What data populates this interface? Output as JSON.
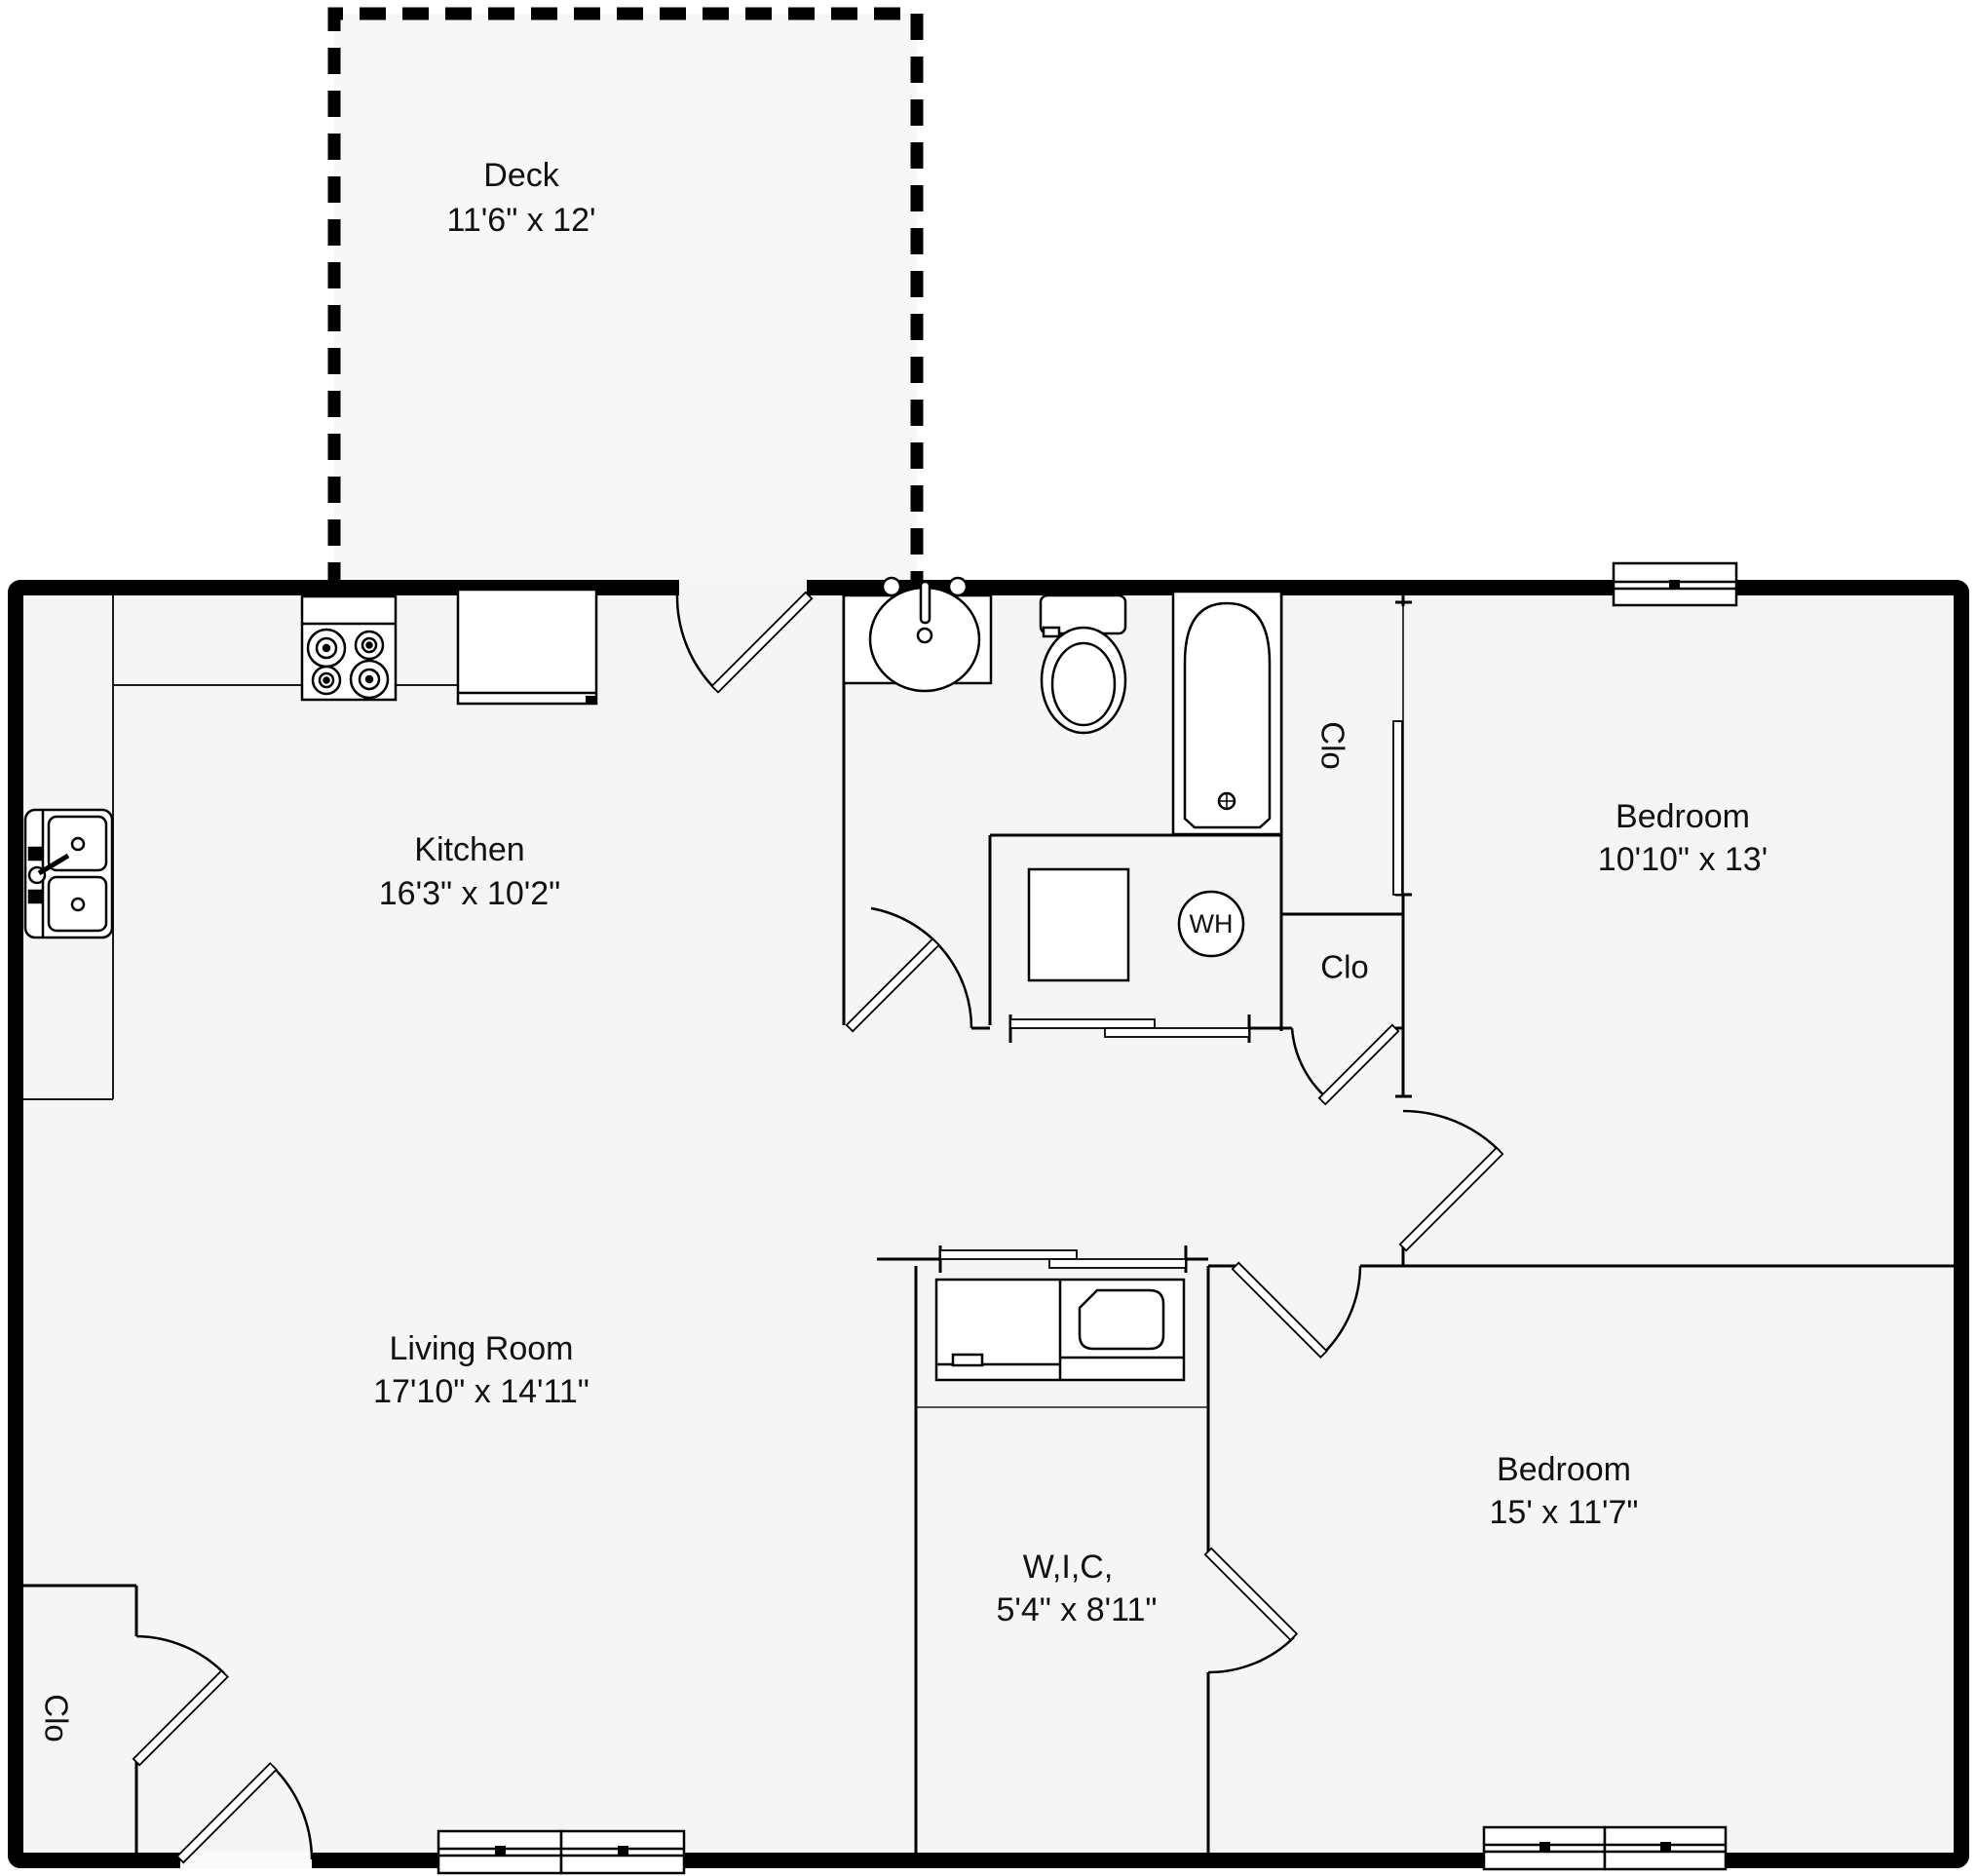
{
  "plan_title": "Apartment floor plan",
  "colors": {
    "wall": "#000000",
    "interior_line": "#1a1a1a",
    "floor_fill": "#f5f5f5",
    "deck_fill": "#f7f7f7",
    "background": "#ffffff",
    "fixture_fill": "#ffffff"
  },
  "rooms": {
    "deck": {
      "name": "Deck",
      "dims": "11'6\" x 12'"
    },
    "kitchen": {
      "name": "Kitchen",
      "dims": "16'3\" x 10'2\""
    },
    "living_room": {
      "name": "Living Room",
      "dims": "17'10\" x 14'11\""
    },
    "bedroom_top": {
      "name": "Bedroom",
      "dims": "10'10\" x 13'"
    },
    "bedroom_bottom": {
      "name": "Bedroom",
      "dims": "15' x 11'7\""
    },
    "walk_in_closet": {
      "name": "W,I,C,",
      "dims": "5'4\" x 8'11\""
    }
  },
  "labels": {
    "closet": "Clo",
    "water_heater": "WH"
  }
}
